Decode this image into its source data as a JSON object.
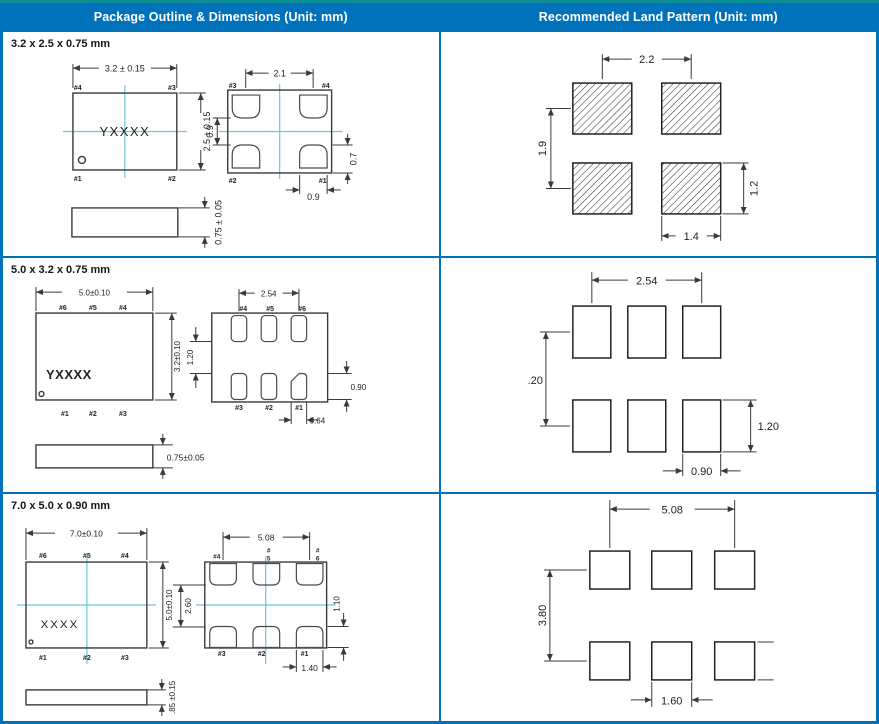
{
  "header": {
    "left": "Package Outline & Dimensions (Unit: mm)",
    "right": "Recommended Land Pattern (Unit: mm)"
  },
  "colors": {
    "accent": "#0072BC",
    "top_edge": "#0E8C94",
    "crosshair": "#6CC5E4",
    "line": "#3A3A3A"
  },
  "sections": [
    {
      "label": "3.2 x 2.5 x 0.75 mm",
      "outline": {
        "marking": "YXXXX",
        "tv": {
          "tl": "#4",
          "tr": "#3",
          "bl": "#1",
          "br": "#2"
        },
        "bv": {
          "tl": "#3",
          "tr": "#4",
          "bl": "#2",
          "br": "#1"
        },
        "dim_w": "3.2 ± 0.15",
        "dim_h": "2.5 ± 0.15",
        "dim_t": "0.75 ± 0.05",
        "dim_pitch": "2.1",
        "dim_gap": "0.9",
        "dim_pad_h": "0.7",
        "dim_pad_w": "0.9"
      },
      "land": {
        "pitch_x": "2.2",
        "pitch_y": "1.9",
        "pad_h": "1.2",
        "pad_w": "1.4"
      }
    },
    {
      "label": "5.0 x 3.2 x 0.75 mm",
      "outline": {
        "marking": "YXXXX",
        "tv_top": [
          "#6",
          "#5",
          "#4"
        ],
        "tv_bot": [
          "#1",
          "#2",
          "#3"
        ],
        "bv_top": [
          "#4",
          "#5",
          "#6"
        ],
        "bv_bot": [
          "#3",
          "#2",
          "#1"
        ],
        "dim_w": "5.0±0.10",
        "dim_h": "3.2±0.10",
        "dim_t": "0.75±0.05",
        "dim_pitch": "2.54",
        "dim_gap": "1.20",
        "dim_pad_h": "0.90",
        "dim_pad_w": "0.64"
      },
      "land": {
        "pitch_x": "2.54",
        "pitch_y": ".20",
        "pad_h": "1.20",
        "pad_w": "0.90"
      }
    },
    {
      "label": "7.0 x 5.0 x 0.90 mm",
      "outline": {
        "marking": "XXXX",
        "tv_top": [
          "#6",
          "#5",
          "#4"
        ],
        "tv_bot": [
          "#1",
          "#2",
          "#3"
        ],
        "bv_top": [
          "#4",
          "#",
          "5",
          "#",
          "6"
        ],
        "bv_bot": [
          "#3",
          "#2",
          "#1"
        ],
        "dim_w": "7.0±0.10",
        "dim_h": "5.0±0.10",
        "dim_gap2": "2.60",
        "dim_t": ".85 ±0.15",
        "dim_pitch": "5.08",
        "dim_pad_h": "1.10",
        "dim_pad_w": "1.40"
      },
      "land": {
        "pitch_x": "5.08",
        "pitch_y": "3.80",
        "pad_w": "1.60"
      }
    }
  ]
}
